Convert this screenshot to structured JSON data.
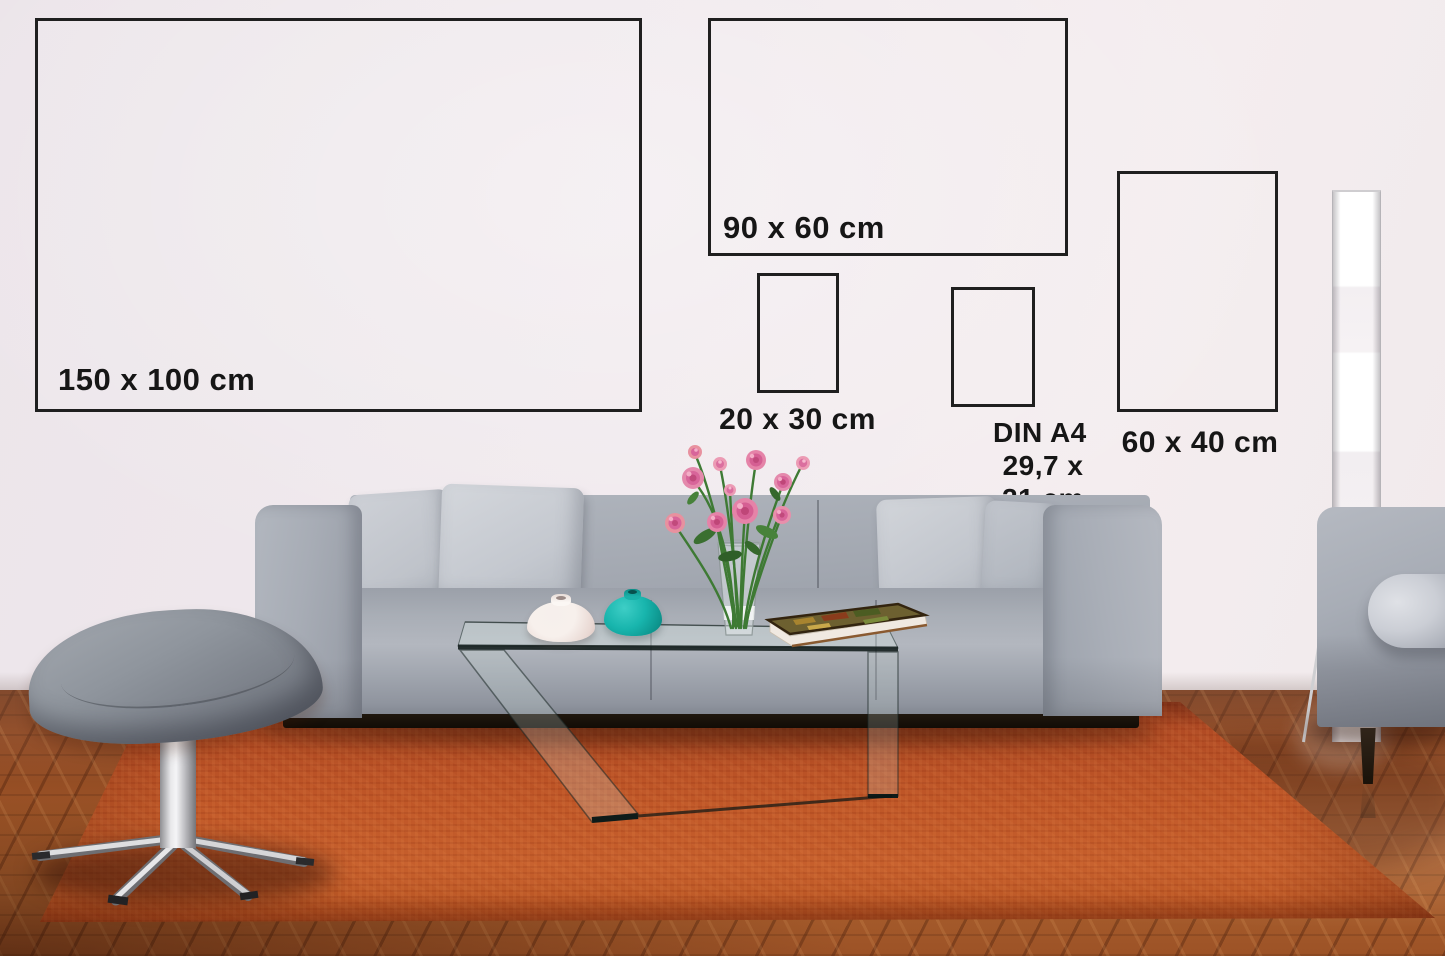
{
  "size_guide": {
    "frames": [
      {
        "name": "150x100",
        "label": "150 x 100 cm"
      },
      {
        "name": "90x60",
        "label": "90 x 60 cm"
      },
      {
        "name": "20x30",
        "label": "20 x 30 cm"
      },
      {
        "name": "din_a4",
        "label": "DIN A4",
        "sublabel": "29,7 x 21 cm"
      },
      {
        "name": "60x40",
        "label": "60 x 40 cm"
      }
    ]
  },
  "scene": {
    "objects": [
      "gray sofa with light pillows",
      "gray egg stool on chrome star base",
      "glass z-shaped coffee table",
      "pink ranunculus bouquet in glass vase",
      "white vase",
      "teal vase",
      "book on table",
      "white paper floor lamp",
      "second gray sofa (right edge)",
      "rust orange rug",
      "herringbone wood floor"
    ]
  },
  "colors": {
    "frame_border": "#1f1f1f",
    "label_text": "#161616",
    "wall": "#f0e9ed",
    "sofa": "#a3a8b1",
    "pillow": "#cacdd4",
    "rug": "#b5502a",
    "floor": "#8a4a22",
    "teal_vase": "#18b5ad",
    "white_vase": "#f6efec",
    "flower_pink": "#e07da6",
    "stem_green": "#3e7a34"
  }
}
